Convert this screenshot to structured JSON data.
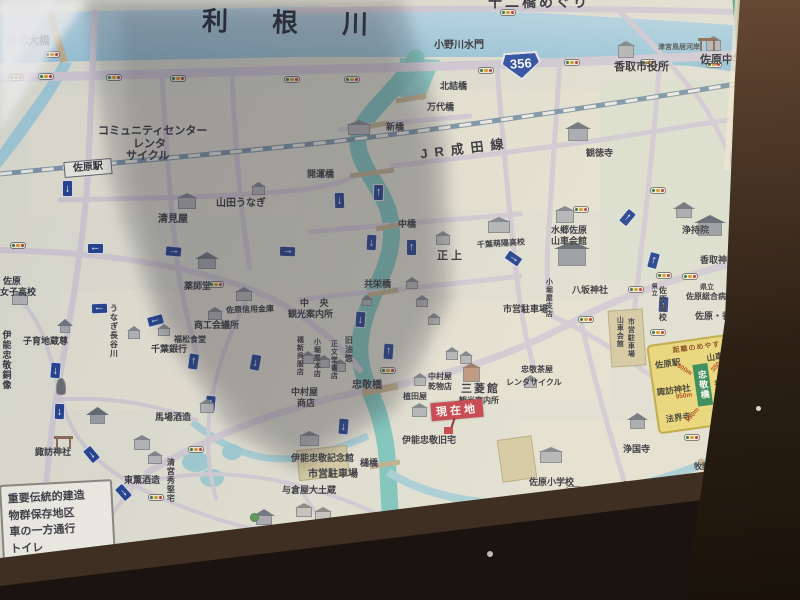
{
  "labels": {
    "tone_river": "利根川",
    "suigo_ohashi": "水郷大橋",
    "juni_bashi_meguri": "十二橋めぐり",
    "onogawa_suimon": "小野川水門",
    "katori_cityhall": "香取市役所",
    "sawara_jhs": "佐原中学校",
    "tsunomiya_kashi": "津宮鳥居河岸",
    "kitazume_bashi": "北詰橋",
    "bandai_bashi": "万代橋",
    "community_center": "コミュニティセンター",
    "rental_cycle1": "レンタ",
    "rental_cycle2": "サイクル",
    "shinbashi": "新橋",
    "sawara_station": "佐原駅",
    "katori_station": "香取駅",
    "narita_line": "JR成田線",
    "higashikanto_expwy": "東関東自動車道",
    "kaiun_bashi": "開運橋",
    "yamada_unagi": "山田うなぎ",
    "kantoku_ji": "観徳寺",
    "kiyomiya": "清見屋",
    "naka_bashi": "中橋",
    "dashi_kaikan1": "水郷佐原",
    "dashi_kaikan2": "山車会館",
    "shoujou": "正上",
    "chiba_hoyo_hs": "千葉萌陽高校",
    "joji_in": "浄持院",
    "kyoei_bashi": "共栄橋",
    "yasaka_jinja": "八坂神社",
    "kobori_ya_branch": "小堀屋支店",
    "katori_jingu": "香取神宮",
    "pref1": "県立",
    "sawara_hospital": "佐原総合病院",
    "pref2": "県立",
    "sawara_hs": "佐原高校",
    "sawara_katori_ic": "佐原・香取IC",
    "yakushido": "薬師堂",
    "joshi_hs1": "佐原",
    "joshi_hs2": "女子高校",
    "sawara_shinkin": "佐原信用金庫",
    "shoko_kaigisho": "商工会議所",
    "chuo_kanko1": "中 央",
    "chuo_kanko2": "観光案内所",
    "fukumatsu_shokudo": "福松食堂",
    "kosodate_jizo": "子育地蔵尊",
    "chiba_bank": "千葉銀行",
    "unagi_hasegawa": "うなぎ長谷川",
    "fukushin_gofuku": "福新呉服店",
    "kobori_ya_honten": "小堀屋本店",
    "shobundo_shoten": "正文堂書店",
    "kyu_aburaso": "旧油惣",
    "ino_statue": "伊能忠敬銅像",
    "parking_right": "市営駐車場",
    "dashi_parking1": "山車会館",
    "dashi_parking2": "市営駐車場",
    "chukei_bashi": "忠敬橋",
    "nakamuraya_shoten1": "中村屋",
    "nakamuraya_shoten2": "商店",
    "nakamuraya_kanbutsu1": "中村屋",
    "nakamuraya_kanbutsu2": "乾物店",
    "mitsubishi_kan": "三菱館",
    "mitsubishi_kanko": "観光案内所",
    "ueda_ya": "植田屋",
    "chukei_chaya": "忠敬茶屋",
    "chaya_rental": "レンタサイクル",
    "ino_kyutaku": "伊能忠敬旧宅",
    "toyo_hashi": "樋橋",
    "ino_kinenkan": "伊能忠敬記念館",
    "parking_left": "市営駐車場",
    "yokuraya": "与倉屋大土蔵",
    "baba_shuzo": "馬場酒造",
    "tokun_shuzo": "東薫酒造",
    "seimiya_hidekata": "清宮秀堅宅",
    "suwa_jinja": "諏訪神社",
    "hokai_ji": "法界寺",
    "jodo_ji": "浄土寺",
    "joko_ji": "浄国寺",
    "makino_bashi": "牧野橋",
    "kanpuku_ji": "観福寺",
    "sawara_es": "佐原小学校",
    "gakko_bashi": "学校橋",
    "sawarae_bashi": "佐原江橋"
  },
  "route_shield": {
    "number": "356"
  },
  "current_location": {
    "label": "現在地"
  },
  "dedication": {
    "text": "贈　佐原商工会議所創立50周年記念"
  },
  "legend": {
    "lines": [
      "重要伝統的建造",
      "物群保存地区",
      "車の一方通行",
      "トイレ"
    ]
  },
  "distance_box": {
    "title": "距離のめやす",
    "center": "忠敬橋",
    "items": [
      {
        "name": "佐原駅",
        "distance": "600m"
      },
      {
        "name": "山車会館",
        "distance": "350m"
      },
      {
        "name": "諏訪神社",
        "distance": "950m"
      },
      {
        "name": "香取神宮",
        "distance": "2.5km"
      },
      {
        "name": "法界寺",
        "distance": "550m"
      },
      {
        "name": "観福寺",
        "distance": "1.1km"
      }
    ]
  },
  "icons": {
    "traffic_signal": "signal-pill",
    "one_way_arrow_glyph": "↑",
    "current_location_marker": "red-square",
    "ic_marker": "green-circle",
    "torii": "torii-gate",
    "tree": "green-circle-tree"
  },
  "colors": {
    "board_bg": "#e5e6da",
    "tone_river": "#9ccadf",
    "onogawa": "#7ecac4",
    "road": "#d6d0dc",
    "railway": "#7e98ac",
    "expressway": "#3f9e72",
    "route_shield_blue": "#2a4da8",
    "dedication_blue": "#3b5ea8",
    "current_location_red": "#c9404e",
    "distance_box_yellow": "#eedc7e",
    "distance_center_green": "#2e8a5a",
    "legend_bg": "#f6f6ef",
    "wood_frame": "#2c2015"
  }
}
